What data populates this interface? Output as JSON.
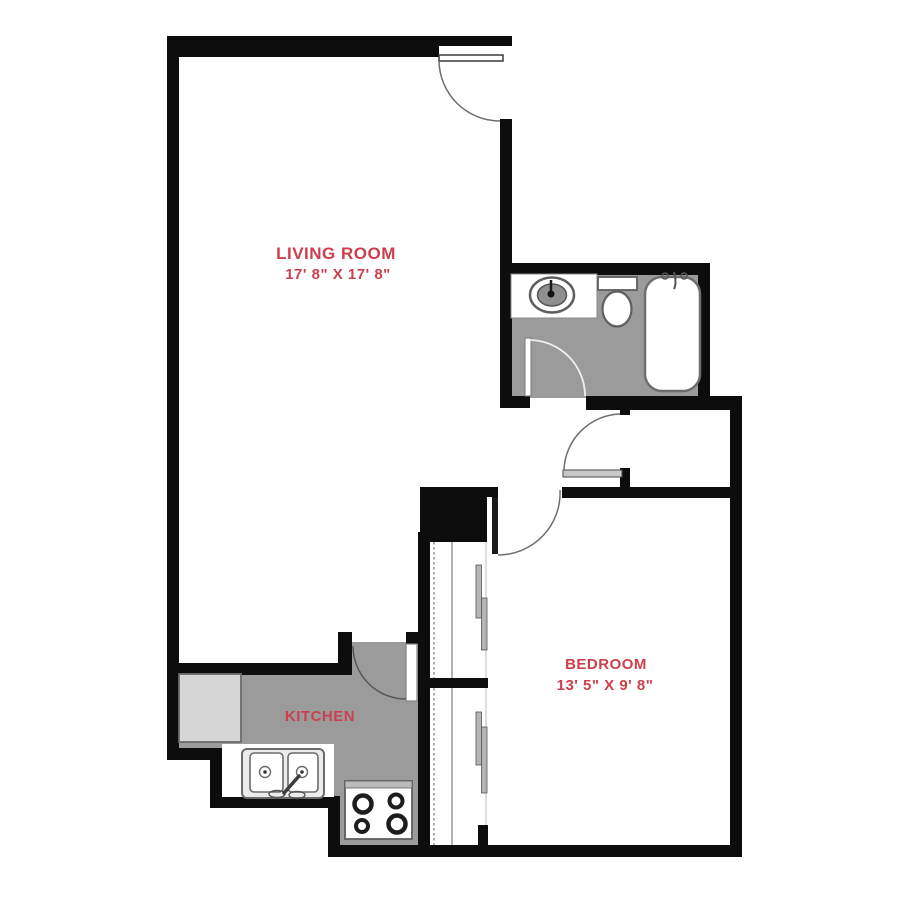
{
  "plan_title": "Apartment Floor Plan",
  "labels": {
    "living_room_name": "LIVING ROOM",
    "living_room_dims": "17' 8\" X 17' 8\"",
    "kitchen_name": "KITCHEN",
    "bedroom_name": "BEDROOM",
    "bedroom_dims": "13' 5\" X 9' 8\""
  },
  "colors": {
    "label_red": "#cc3f4e",
    "wall_black": "#0d0d0d",
    "floor_gray": "#9b9b9b",
    "appliance_gray": "#d6d6d6",
    "door_panel_gray": "#c9c9c9",
    "fixture_stroke": "#6e6e6e"
  },
  "fixtures": [
    "entry-door",
    "bathroom-door",
    "closet-door",
    "bedroom-opening-door",
    "kitchen-door",
    "bathroom-sink",
    "toilet",
    "bathtub",
    "refrigerator",
    "kitchen-double-sink",
    "stove-cooktop",
    "bedroom-closet-sliding-doors"
  ]
}
